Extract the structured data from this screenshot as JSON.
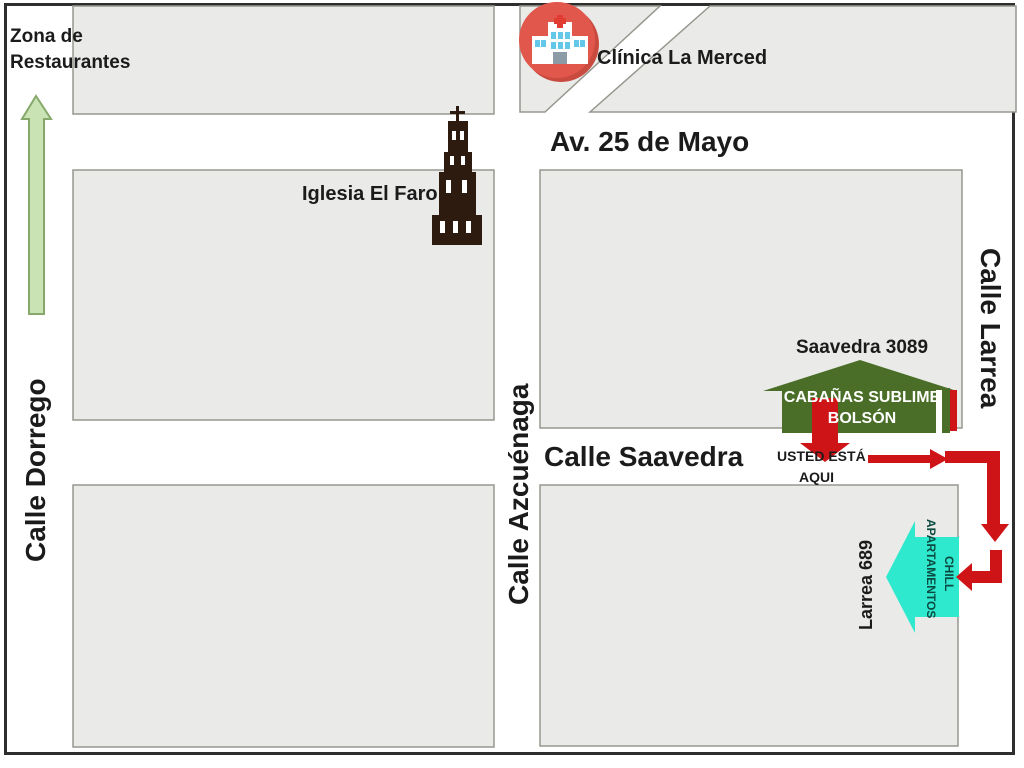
{
  "labels": {
    "zona_restaurantes": {
      "line1": "Zona de",
      "line2": "Restaurantes"
    },
    "clinica": "Clínica La Merced",
    "av_25_de_mayo": "Av. 25 de Mayo",
    "iglesia": "Iglesia El Faro",
    "calle_dorrego": "Calle Dorrego",
    "calle_azcuenaga": "Calle Azcuénaga",
    "calle_saavedra": "Calle Saavedra",
    "calle_larrea": "Calle Larrea",
    "saavedra_3089": "Saavedra 3089",
    "cabanas": {
      "line1": "CABAÑAS SUBLIME",
      "line2": "BOLSÓN"
    },
    "usted_esta_aqui": {
      "line1": "USTED ESTÁ",
      "line2": "AQUI"
    },
    "larrea_689": "Larrea 689",
    "apartamentos": {
      "line1": "APARTAMENTOS",
      "line2": "CHILL"
    }
  },
  "icons": {
    "clinic": "hospital-icon",
    "church": "church-tower-icon",
    "route_start": "you-are-here-arrow",
    "destination": "left-arrow-house"
  },
  "colors": {
    "block_fill": "#EAEAE8",
    "block_border": "#97978F",
    "frame": "#2e2e2e",
    "green_arrow_fill": "#C9E3B4",
    "green_arrow_border": "#86A96B",
    "red": "#CF1418",
    "house_green": "#4A6E28",
    "cyan": "#2FE9CE",
    "church_dark": "#2E1B10",
    "clinic_red": "#E2574C",
    "clinic_red_shadow": "#C94A3F",
    "window_blue": "#63C8E8",
    "door_gray": "#8C9BA6",
    "cross_red": "#E03C31",
    "white": "#FFFFFF",
    "text": "#1b1b1b"
  }
}
